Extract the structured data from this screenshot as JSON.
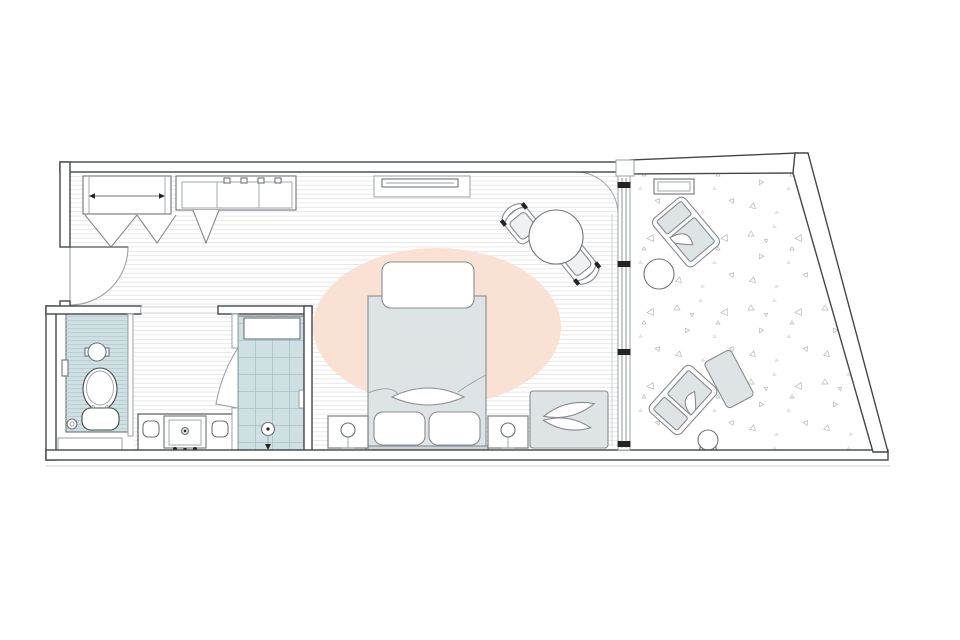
{
  "page": {
    "title": "Hotel guest room floor plan",
    "background": "#ffffff"
  },
  "colors": {
    "wall": "#43474a",
    "fixture_stroke": "#6f7478",
    "furniture_fill": "#dee3e6",
    "furniture_stroke": "#878c90",
    "line_mid": "#9aa0a3",
    "line_light": "#cdd1d3",
    "plank_line": "#e6e6e6",
    "tile_fill": "#cfe0e3",
    "tile_line": "#b4cbd0",
    "grid_line": "#a7c1c7",
    "rug": "#f9e2d3",
    "fleck": "#b5b8b9",
    "fleck_fill": "#e2e4e5",
    "ink": "#232323",
    "glass": "#8e9497"
  },
  "rooms": [
    {
      "name": "entry"
    },
    {
      "name": "bedroom"
    },
    {
      "name": "bathroom"
    },
    {
      "name": "wc"
    },
    {
      "name": "shower"
    },
    {
      "name": "balcony"
    }
  ],
  "furniture": [
    "entry-door",
    "closet-with-rod",
    "bifold-doors",
    "dresser-console",
    "wall-tv",
    "dining-table",
    "dining-chair",
    "area-rug",
    "double-bed",
    "folded-blanket",
    "sleeping-pillows",
    "accent-pillow",
    "nightstand",
    "table-lamp",
    "bench-with-pillows",
    "toilet",
    "round-basin",
    "vanity-sink",
    "shower-bench",
    "floor-drain",
    "glass-slider-wall",
    "lounge-chair",
    "ottoman",
    "side-table",
    "stool",
    "planter"
  ]
}
